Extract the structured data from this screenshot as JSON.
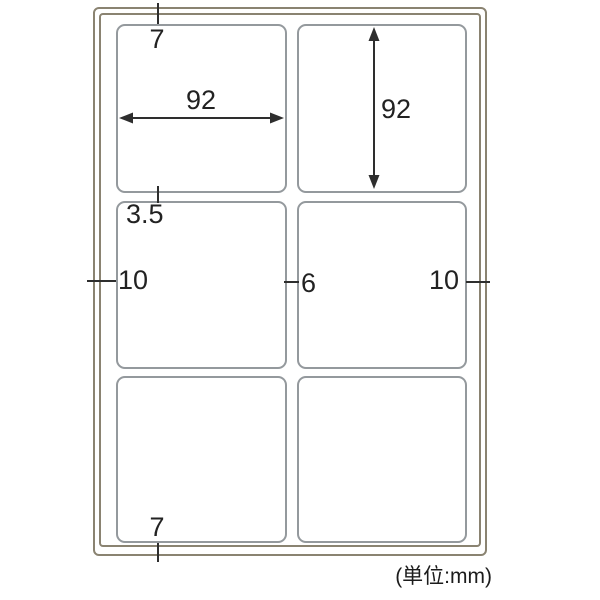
{
  "diagram": {
    "unit_note": "(単位:mm)",
    "sheet": {
      "rows": 3,
      "columns": 2,
      "label_count": 6
    },
    "dimensions": {
      "top_margin": "7",
      "label_width": "92",
      "label_height": "92",
      "row_gap": "3.5",
      "left_margin": "10",
      "column_gap": "6",
      "right_margin": "10",
      "bottom_margin": "7"
    },
    "colors": {
      "sheet_border": "#8a8371",
      "label_border": "#94999d",
      "dimension_ink": "#2e2e2e"
    }
  }
}
